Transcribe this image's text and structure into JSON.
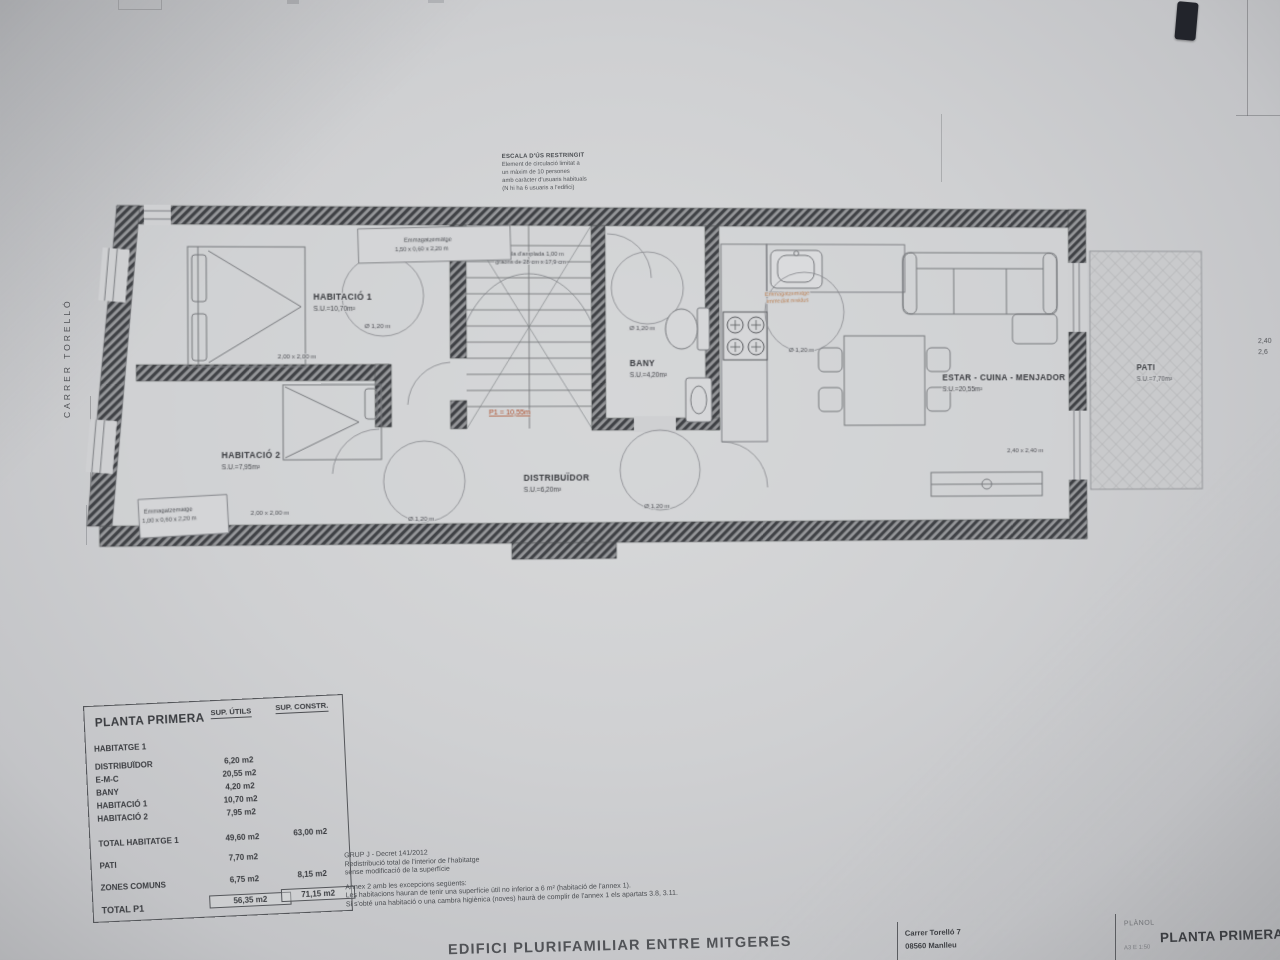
{
  "sheet": {
    "street_label": "CARRER TORELLÓ",
    "footer_title": "EDIFICI PLURIFAMILIAR ENTRE MITGERES",
    "edge_dim_1": "2,40",
    "edge_dim_2": "2,6"
  },
  "plan": {
    "rooms": {
      "hab1": {
        "name": "HABITACIÓ 1",
        "area": "S.U.=10,70m²"
      },
      "hab2": {
        "name": "HABITACIÓ 2",
        "area": "S.U.=7,95m²"
      },
      "bany": {
        "name": "BANY",
        "area": "S.U.=4,20m²"
      },
      "distribuidor": {
        "name": "DISTRIBUÏDOR",
        "area": "S.U.=6,20m²"
      },
      "estar": {
        "name": "ESTAR - CUINA - MENJADOR",
        "area": "S.U.=20,55m²"
      },
      "pati": {
        "name": "PATI",
        "area": "S.U.=7,70m²"
      }
    },
    "labels": {
      "diameter": "Ø 1,20 m",
      "bed_dim": "2,00 x 2,00 m",
      "estar_dim": "2,40 x 2,40 m",
      "p1_height": "P1 = 10,55m",
      "storage_top_1": "Emmagatzematge",
      "storage_top_2": "1,50 x 0,60 x 2,20 m",
      "storage_bottom_1": "Emmagatzematge",
      "storage_bottom_2": "1,00 x 0,60 x 2,20 m",
      "storage_kitchen_1": "Emmagatzematge",
      "storage_kitchen_2": "immediat residus",
      "stair_1": "Escala d'amplada 1,00 m",
      "stair_2": "graons de 28 cm x 17,9 cm"
    },
    "use_note": [
      "ESCALA D'ÚS RESTRINGIT",
      "Element de circulació limitat a",
      "un màxim de 10 persones",
      "amb caràcter d'usuaris habituals",
      "(N hi ha 6 usuaris a l'edifici)"
    ]
  },
  "table": {
    "title": "PLANTA PRIMERA",
    "col_utils": "SUP. ÚTILS",
    "col_constr": "SUP. CONSTR.",
    "section": "HABITATGE 1",
    "rows": [
      {
        "label": "DISTRIBUÏDOR",
        "utils": "6,20 m2"
      },
      {
        "label": "E-M-C",
        "utils": "20,55 m2"
      },
      {
        "label": "BANY",
        "utils": "4,20 m2"
      },
      {
        "label": "HABITACIÓ 1",
        "utils": "10,70 m2"
      },
      {
        "label": "HABITACIÓ 2",
        "utils": "7,95 m2"
      }
    ],
    "total_hab": {
      "label": "TOTAL HABITATGE 1",
      "utils": "49,60 m2",
      "constr": "63,00 m2"
    },
    "pati_row": {
      "label": "PATI",
      "utils": "7,70 m2"
    },
    "comuns": {
      "label": "ZONES COMUNS",
      "utils": "6,75 m2",
      "constr": "8,15 m2"
    },
    "total": {
      "label": "TOTAL P1",
      "utils": "56,35 m2",
      "constr": "71,15 m2"
    }
  },
  "notes": {
    "lines1": [
      "GRUP J - Decret 141/2012",
      "Redistribució total de l'interior de l'habitatge",
      "sense modificació de la superfície"
    ],
    "lines2": [
      "Annex 2 amb les excepcions següents:",
      "Les habitacions hauran de tenir una superfície útil no inferior a 6 m² (habitació de l'annex 1).",
      "Si s'obté una habitació o una cambra higiènica (noves) haurà de complir de l'annex 1 els apartats 3.8, 3.11."
    ]
  },
  "titleblock": {
    "address1": "Carrer Torelló 7",
    "address2": "08560 Manlleu",
    "planol_label": "PLÀNOL",
    "scale": "A3 E 1:50",
    "sheet_title": "PLANTA PRIMERA - R"
  }
}
